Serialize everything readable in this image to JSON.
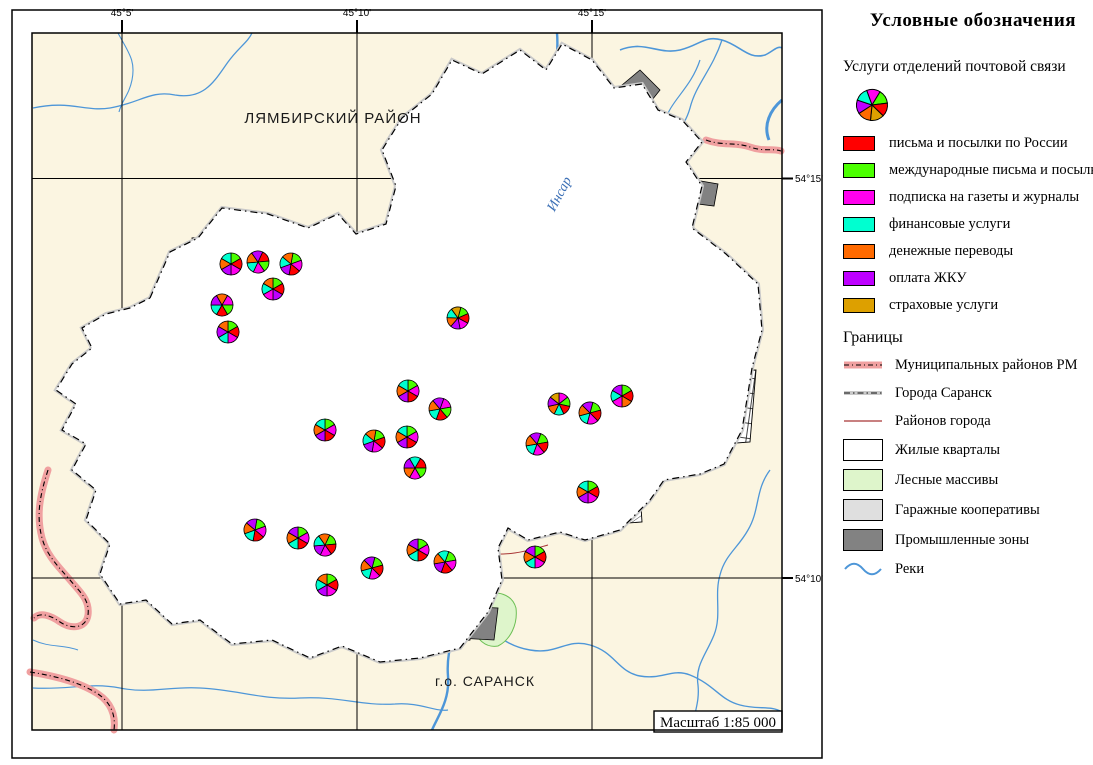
{
  "colors": {
    "services": {
      "R": "#FF0000",
      "G": "#4BFF00",
      "M": "#FF00EE",
      "C": "#00FFD0",
      "O": "#FF6A00",
      "P": "#BE00FF",
      "Y": "#DDA000"
    },
    "map_bg": "#FBF5E1",
    "forest": "#DEF5CB",
    "industrial": "#828282",
    "garage": "#DFDFDF",
    "residential": "#FFFFFF",
    "river": "#4D96D8",
    "district_line": "#A83434",
    "municipal_band": "#F0A0A0"
  },
  "legend": {
    "title": "Условные обозначения",
    "subtitle": "Услуги отделений почтовой связи",
    "pie_slices": "MGRYOPC",
    "services": [
      {
        "label": "письма и посылки по России",
        "color_key": "R"
      },
      {
        "label": "международные письма и посылки",
        "color_key": "G"
      },
      {
        "label": "подписка на газеты и журналы",
        "color_key": "M"
      },
      {
        "label": "финансовые услуги",
        "color_key": "C"
      },
      {
        "label": "денежные переводы",
        "color_key": "O"
      },
      {
        "label": "оплата ЖКУ",
        "color_key": "P"
      },
      {
        "label": "страховые услуги",
        "color_key": "Y"
      }
    ],
    "boundaries_title": "Границы",
    "boundaries": [
      {
        "label": "Муниципальных районов РМ",
        "type": "municipal-band"
      },
      {
        "label": "Города Саранск",
        "type": "city-dashdot"
      },
      {
        "label": "Районов города",
        "type": "district-line"
      },
      {
        "label": "Жилые кварталы",
        "type": "residential"
      },
      {
        "label": "Лесные массивы",
        "type": "forest"
      },
      {
        "label": "Гаражные кооперативы",
        "type": "garage"
      },
      {
        "label": "Промышленные зоны",
        "type": "industrial"
      },
      {
        "label": "Реки",
        "type": "river"
      }
    ]
  },
  "map": {
    "labels": {
      "district": "ЛЯМБИРСКИЙ РАЙОН",
      "city": "г.о. САРАНСК",
      "river": "Инсар",
      "scale": "Масштаб 1:85 000"
    },
    "graticule": {
      "top": [
        "45°5'",
        "45°10'",
        "45°15'"
      ],
      "right": [
        "54°15'",
        "54°10'"
      ]
    },
    "pies": [
      {
        "x": 231,
        "y": 264,
        "rot": 0,
        "slices": "GRMPOC"
      },
      {
        "x": 258,
        "y": 262,
        "rot": 25,
        "slices": "RGMCOP"
      },
      {
        "x": 291,
        "y": 264,
        "rot": 10,
        "slices": "GMRPCO"
      },
      {
        "x": 273,
        "y": 289,
        "rot": 0,
        "slices": "GRPMCO"
      },
      {
        "x": 222,
        "y": 305,
        "rot": 30,
        "slices": "MGRCPO"
      },
      {
        "x": 228,
        "y": 332,
        "rot": 0,
        "slices": "GRMCPO"
      },
      {
        "x": 458,
        "y": 318,
        "rot": 15,
        "slices": "GRMPOCY"
      },
      {
        "x": 408,
        "y": 391,
        "rot": 0,
        "slices": "GMRPOC"
      },
      {
        "x": 440,
        "y": 409,
        "rot": 20,
        "slices": "MGRCOP"
      },
      {
        "x": 325,
        "y": 430,
        "rot": 0,
        "slices": "GMRPOC"
      },
      {
        "x": 374,
        "y": 441,
        "rot": 10,
        "slices": "GRMPCO"
      },
      {
        "x": 407,
        "y": 437,
        "rot": 0,
        "slices": "GMRPOC"
      },
      {
        "x": 415,
        "y": 468,
        "rot": 30,
        "slices": "RGMOPC"
      },
      {
        "x": 559,
        "y": 404,
        "rot": 0,
        "slices": "MGRCOPY"
      },
      {
        "x": 590,
        "y": 413,
        "rot": 15,
        "slices": "GRMCOP"
      },
      {
        "x": 622,
        "y": 396,
        "rot": 0,
        "slices": "GROMCP"
      },
      {
        "x": 537,
        "y": 444,
        "rot": 20,
        "slices": "GRMCOP"
      },
      {
        "x": 588,
        "y": 492,
        "rot": 0,
        "slices": "GRMPOC"
      },
      {
        "x": 255,
        "y": 530,
        "rot": 10,
        "slices": "GMRCOP"
      },
      {
        "x": 298,
        "y": 538,
        "rot": 0,
        "slices": "GMRCOP"
      },
      {
        "x": 325,
        "y": 545,
        "rot": 25,
        "slices": "GRMPCO"
      },
      {
        "x": 327,
        "y": 585,
        "rot": 0,
        "slices": "GRMPCO"
      },
      {
        "x": 372,
        "y": 568,
        "rot": 15,
        "slices": "GRMCOP"
      },
      {
        "x": 418,
        "y": 550,
        "rot": 0,
        "slices": "GMRCOP"
      },
      {
        "x": 445,
        "y": 562,
        "rot": 20,
        "slices": "GMRPOC"
      },
      {
        "x": 535,
        "y": 557,
        "rot": 0,
        "slices": "GRMCOP"
      }
    ]
  }
}
